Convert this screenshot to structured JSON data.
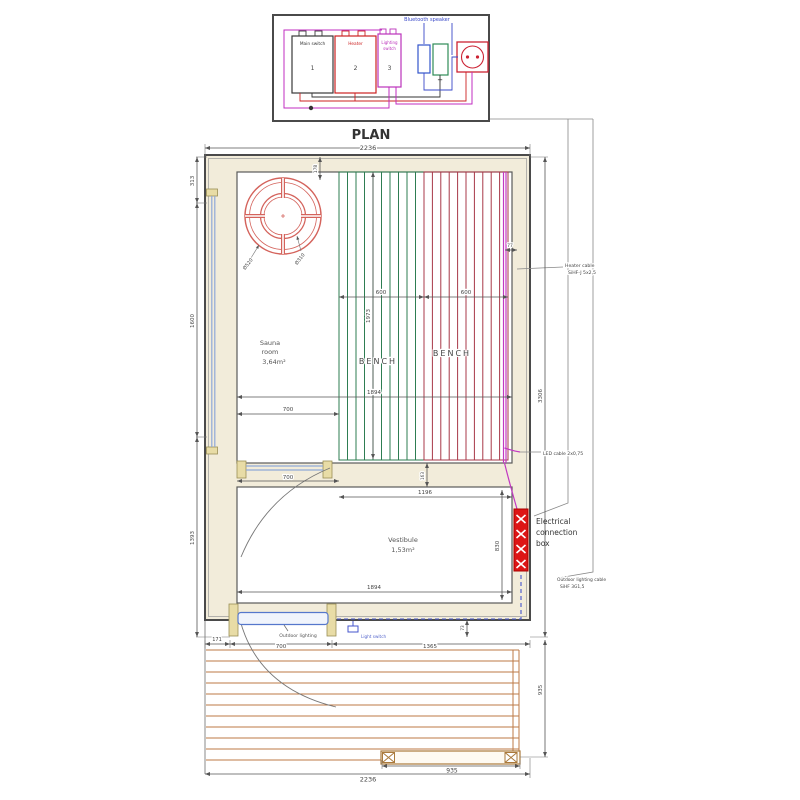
{
  "schematic": {
    "bluetooth_label": "Bluetooth speaker",
    "components": [
      {
        "label_lines": [
          "Main switch"
        ],
        "number": "1"
      },
      {
        "label_lines": [
          "Heater"
        ],
        "number": "2"
      },
      {
        "label_lines": [
          "Lighting",
          "switch"
        ],
        "number": "3"
      }
    ],
    "plus_sign": "+"
  },
  "plan": {
    "title": "PLAN",
    "sauna": {
      "name_line1": "Sauna",
      "name_line2": "room",
      "area": "3,64m²"
    },
    "vestibule": {
      "name": "Vestibule",
      "area": "1,53m²"
    },
    "bench_label": "BENCH",
    "heater": {
      "outer_label": "Ø520",
      "inner_label": "Ø310"
    },
    "notes": {
      "heater_cable": [
        "Heater cable",
        "SiHF-J 5x2,5"
      ],
      "led_cable": "LED cable 2x0,75",
      "connection_box": [
        "Electrical",
        "connection",
        "box"
      ],
      "outdoor_cable": [
        "Outdoor lighting cable",
        "SiHF 3G1,5"
      ],
      "outdoor_lighting": "Outdoor lighting",
      "light_switch": "Light switch"
    },
    "dims": {
      "top_width": "2236",
      "left_top": "313",
      "left_sauna": "1600",
      "left_vestibule": "1393",
      "top_wall": "178",
      "right_wall": "77",
      "right_total": "3306",
      "right_deck": "935",
      "bench_left": "600",
      "bench_right": "600",
      "bench_length": "1973",
      "sauna_width": "1894",
      "sauna_clear": "700",
      "glass_width": "700",
      "vest_clear": "1196",
      "wall_gap": "163",
      "vest_depth": "830",
      "vest_width": "1894",
      "deck_left": "171",
      "deck_door": "700",
      "deck_right": "1365",
      "step": "73",
      "deck_bench": "935",
      "bottom_width": "2236"
    }
  },
  "colors": {
    "wall_outline": "#4a4a4a",
    "wall_fill": "#f2ecda",
    "dimension": "#555555",
    "heater_red": "#d4635c",
    "bench_green": "#2e7d52",
    "bench_red": "#a83848",
    "led_magenta": "#c238c2",
    "glass_blue": "#8fa8d8",
    "deck_wood": "#bc7a45",
    "connection_box_red": "#dd1515",
    "cable_blue": "#4455cc",
    "schematic_magenta": "#c02cc0",
    "schematic_red": "#cc2222",
    "schematic_blue": "#3a49c8",
    "schematic_green": "#2e8b57"
  }
}
